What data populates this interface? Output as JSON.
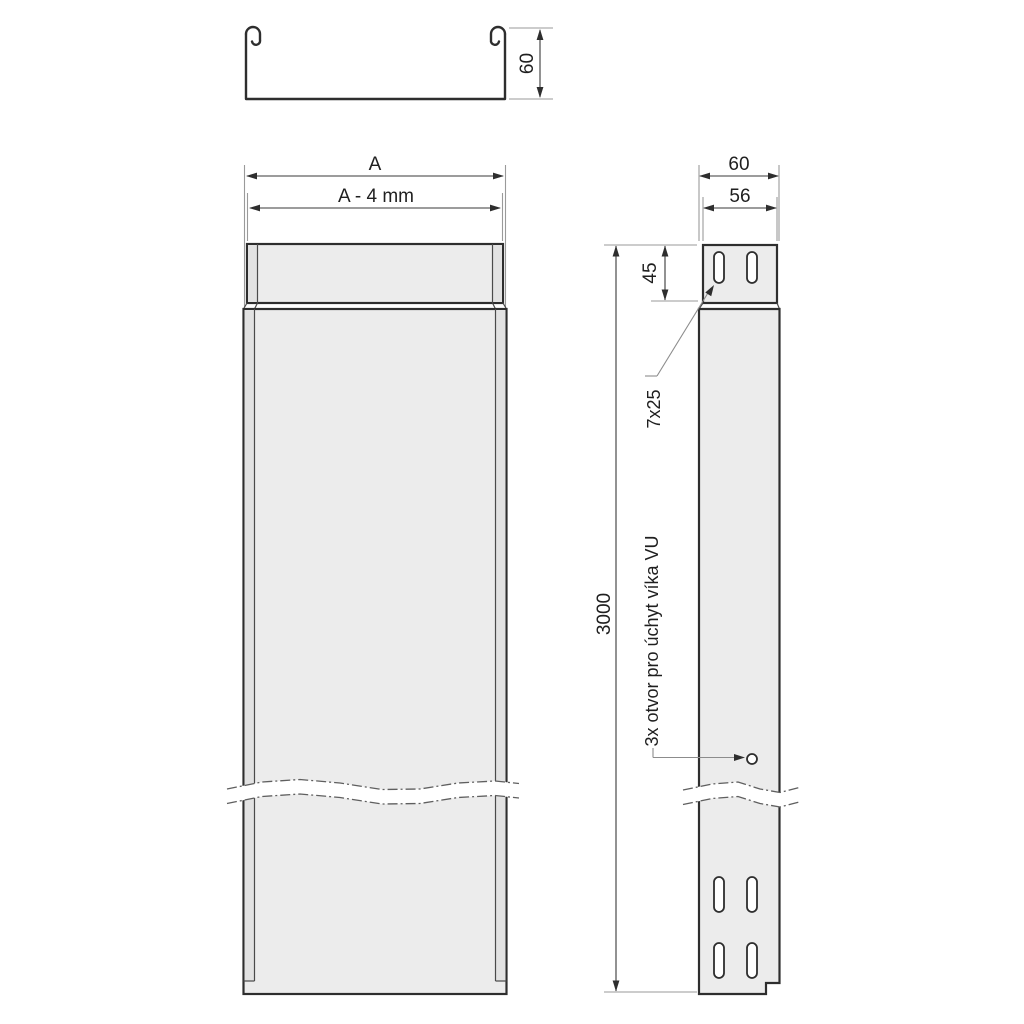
{
  "drawing_title": "",
  "colors": {
    "background": "#ffffff",
    "part_fill": "#ececec",
    "edge_strip_fill": "#e2e2e2",
    "outline": "#2e2e2e",
    "dimension_line": "#3a3a3a",
    "extension_line": "#9a9a9a",
    "break_line": "#5f5f5f",
    "text": "#1f1f1f"
  },
  "cross_section_view": {
    "height_label": "60"
  },
  "front_view": {
    "overall_width_label": "A",
    "inner_width_label": "A - 4 mm"
  },
  "side_view": {
    "overall_depth_label": "60",
    "inner_depth_label": "56",
    "collar_height_label": "45",
    "length_label": "3000",
    "slot_size_label": "7x25",
    "hole_note_label": "3x otvor pro úchyt víka VU"
  }
}
